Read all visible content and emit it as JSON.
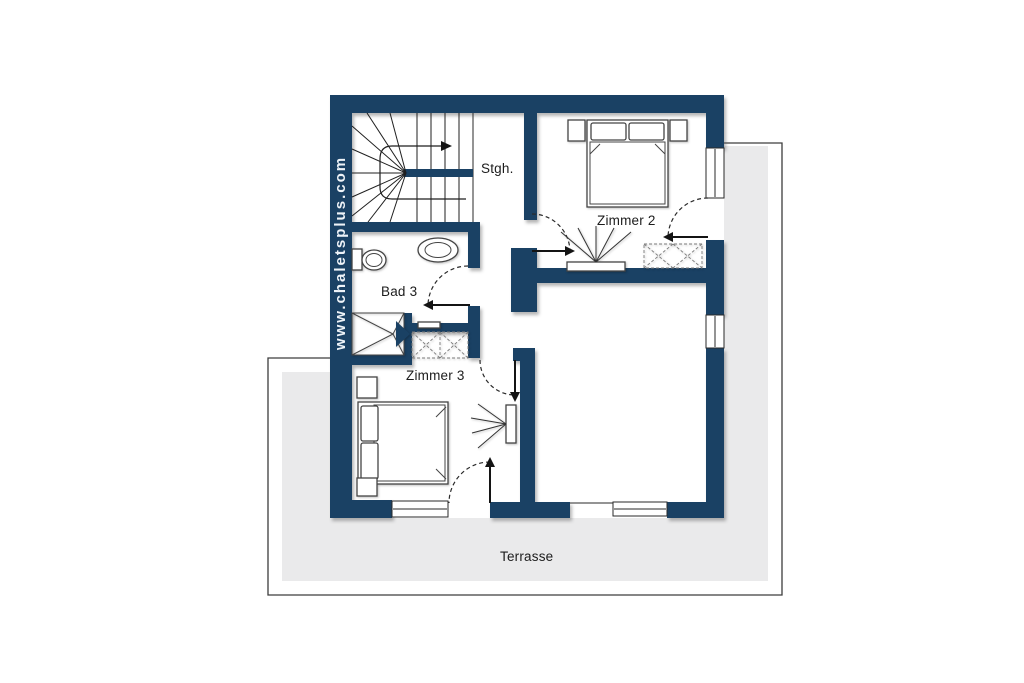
{
  "floorplan": {
    "watermark": "www.chaletsplus.com",
    "labels": {
      "staircase": "Stgh.",
      "zimmer2": "Zimmer 2",
      "bad3": "Bad 3",
      "zimmer3": "Zimmer 3",
      "terrace": "Terrasse"
    },
    "colors": {
      "background": "#ffffff",
      "wall": "#1a4164",
      "terrace_fill": "#eaeaeb",
      "outline": "#3d3d3d",
      "line": "#2a2a2a",
      "furniture_stroke": "#444444",
      "label_text": "#1c1c1c",
      "watermark_text": "#eef3f8"
    }
  }
}
